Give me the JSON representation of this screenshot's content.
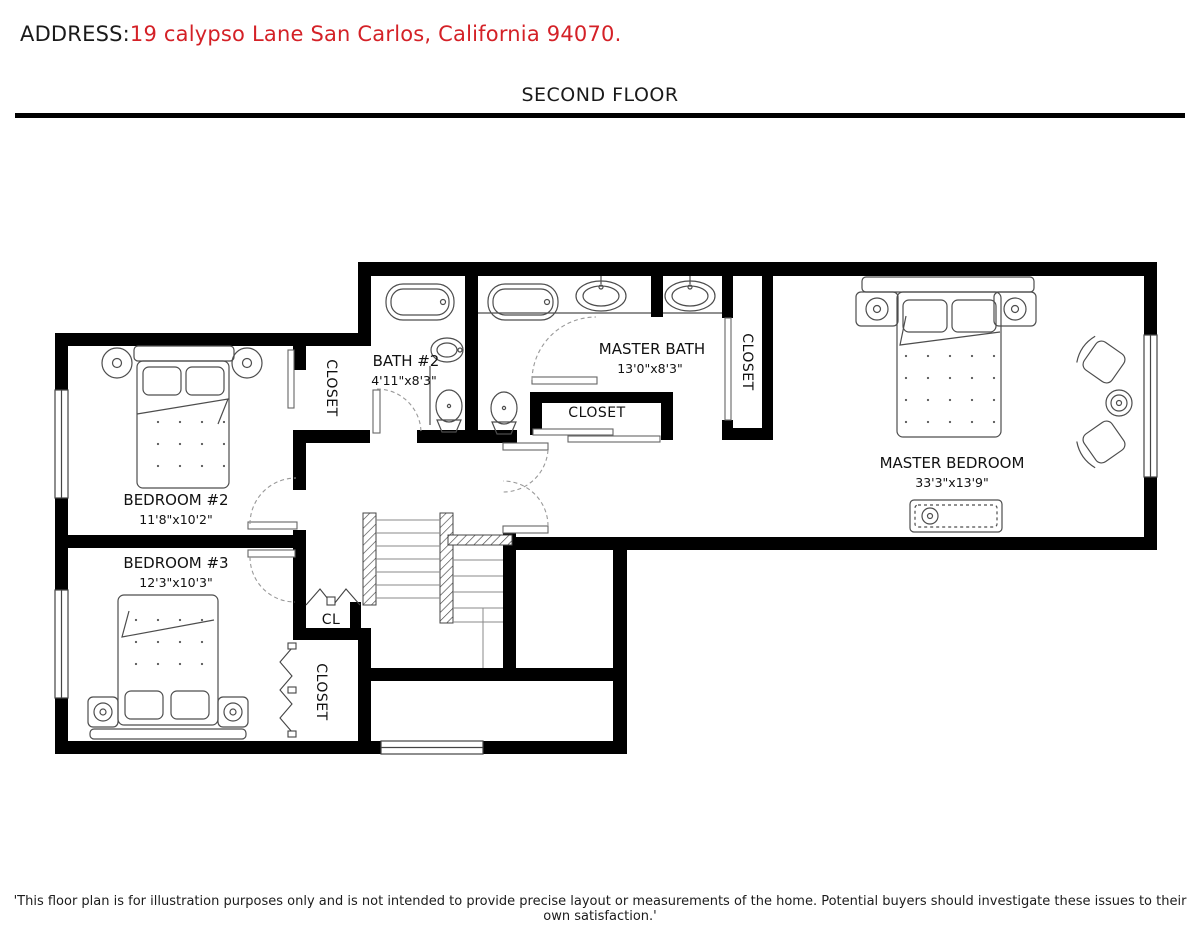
{
  "header": {
    "address_label": "ADDRESS:",
    "address_value": "19 calypso Lane San Carlos, California 94070."
  },
  "title": "SECOND FLOOR",
  "rooms": [
    {
      "name": "BEDROOM #2",
      "dims": "11'8\"x10'2\""
    },
    {
      "name": "BEDROOM #3",
      "dims": "12'3\"x10'3\""
    },
    {
      "name": "BATH #2",
      "dims": "4'11\"x8'3\""
    },
    {
      "name": "MASTER BATH",
      "dims": "13'0\"x8'3\""
    },
    {
      "name": "MASTER BEDROOM",
      "dims": "33'3\"x13'9\""
    }
  ],
  "labels": {
    "closet": "CLOSET",
    "cl": "CL"
  },
  "disclaimer": "'This floor plan is for illustration purposes only and is not intended to provide precise layout or measurements of the home. Potential buyers should investigate these issues to their own satisfaction.'",
  "colors": {
    "address_red": "#d42127",
    "walls": "#000000",
    "fixtures": "#4d4d4d",
    "text": "#1a1a1a"
  }
}
